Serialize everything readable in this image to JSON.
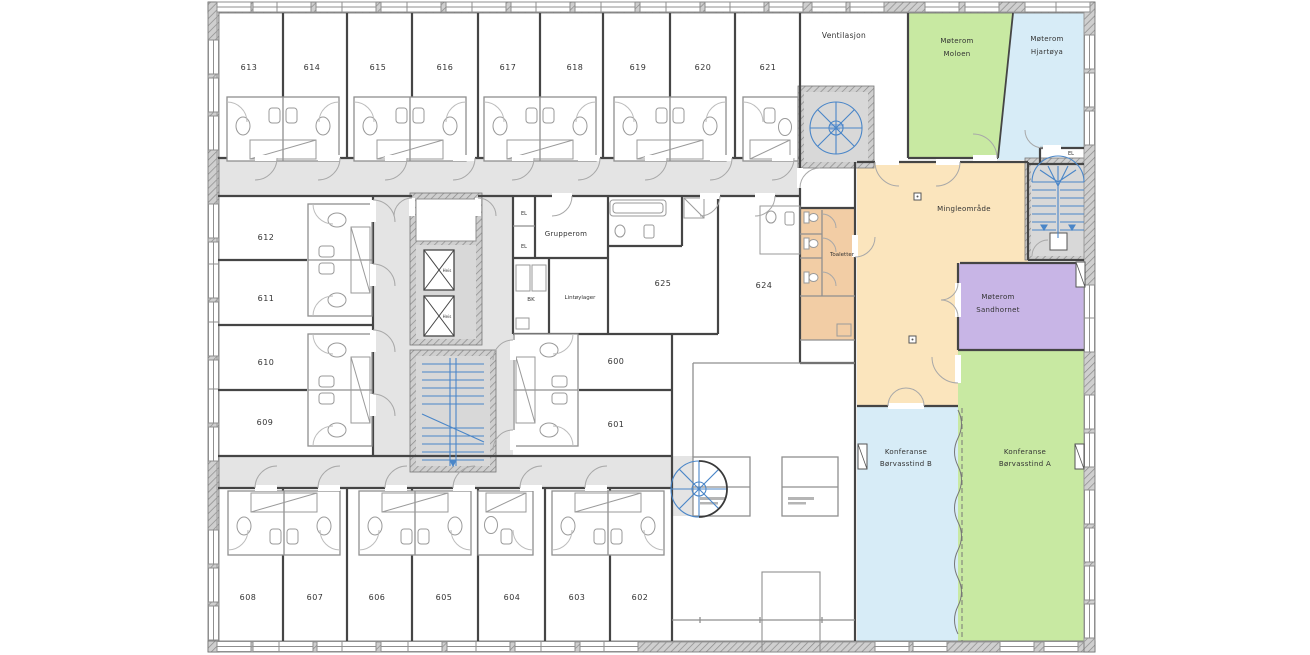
{
  "plan": {
    "rooms_top": [
      "613",
      "614",
      "615",
      "616",
      "617",
      "618",
      "619",
      "620",
      "621"
    ],
    "rooms_left": [
      "612",
      "611",
      "610",
      "609"
    ],
    "rooms_bottom": [
      "608",
      "607",
      "606",
      "605",
      "604",
      "603",
      "602"
    ],
    "rooms_center": [
      "625",
      "624",
      "600",
      "601"
    ],
    "labels": {
      "ventilasjon": "Ventilasjon",
      "grupperom": "Grupperom",
      "lintoylager": "Lintøylager",
      "bk": "BK",
      "el": "EL",
      "heis": "Heis",
      "toaletter": "Toaletter",
      "mingle": "Mingleområde",
      "moloen1": "Møterom",
      "moloen2": "Moloen",
      "hjartoya1": "Møterom",
      "hjartoya2": "Hjartøya",
      "sandhornet1": "Møterom",
      "sandhornet2": "Sandhornet",
      "konfB1": "Konferanse",
      "konfB2": "Børvasstind B",
      "konfA1": "Konferanse",
      "konfA2": "Børvasstind A"
    },
    "colors": {
      "green": "#c8e9a2",
      "blue": "#d7ecf7",
      "orange": "#fbe5bd",
      "salmon": "#f2cda5",
      "purple": "#c8b5e6",
      "corridor": "#e4e4e4",
      "shaft": "#d8d8d8",
      "stair_blue": "#4a86c8"
    }
  }
}
